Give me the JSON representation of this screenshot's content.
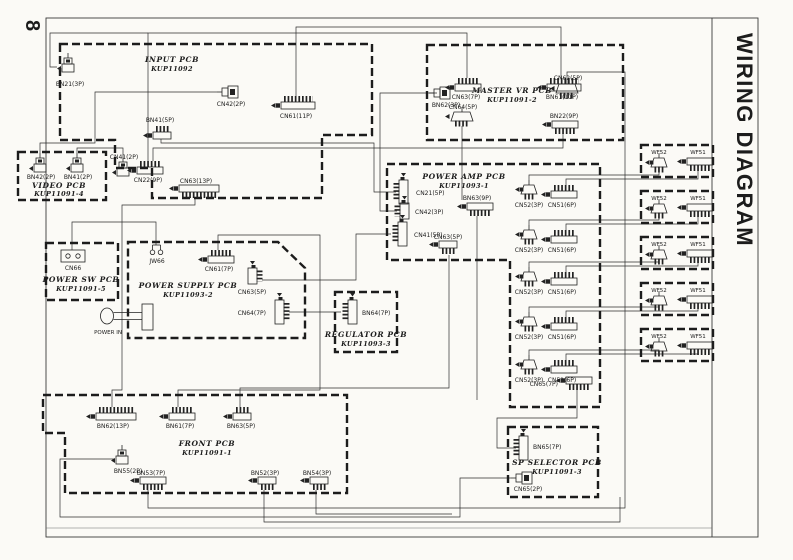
{
  "page": {
    "number": "8",
    "title": "WIRING DIAGRAM"
  },
  "pcbs": {
    "input": {
      "name": "INPUT PCB",
      "model": "KUP11092",
      "connectors": {
        "bn21": "BN21(3P)",
        "cn42": "CN42(2P)",
        "cn61": "CN61(11P)",
        "bn41": "BN41(5P)",
        "cn41": "CN41(2P)",
        "cn22": "CN22(9P)",
        "cn63": "CN63(13P)"
      }
    },
    "video": {
      "name": "VIDEO PCB",
      "model": "KUP11091-4",
      "connectors": {
        "bn42": "BN42(2P)",
        "bn41": "BN41(2P)"
      }
    },
    "master_vr": {
      "name": "MASTER VR PCB",
      "model": "KUP11091-2",
      "connectors": {
        "cn63": "CN63(7P)",
        "bn61": "BN61(11P)",
        "bn62": "BN62(3P)",
        "cn62": "CN62(5P)",
        "cn64": "CN64(5P)",
        "bn22": "BN22(9P)"
      }
    },
    "power_amp": {
      "name": "POWER AMP PCB",
      "model": "KUP11093-1",
      "connectors": {
        "cn21": "CN21(5P)",
        "cn42": "CN42(3P)",
        "cn41": "CN41(5P)",
        "bn63": "BN63(9P)",
        "cn63": "CN63(5P)",
        "cn52": "CN52(3P)",
        "cn51": "CN51(6P)",
        "cn65": "CN65(7P)"
      }
    },
    "power_sw": {
      "name": "POWER SW PCB",
      "model": "KUP11091-5",
      "connectors": {
        "cn66": "CN66"
      }
    },
    "power_supply": {
      "name": "POWER SUPPLY PCB",
      "model": "KUP11093-2",
      "power_in_label": "POWER IN",
      "connectors": {
        "jw66": "JW66",
        "cn61": "CN61(7P)",
        "cn63": "CN63(5P)",
        "cn64": "CN64(7P)"
      }
    },
    "regulator": {
      "name": "REGULATOR PCB",
      "model": "KUP11093-3",
      "connectors": {
        "bn64": "BN64(7P)"
      }
    },
    "front": {
      "name": "FRONT PCB",
      "model": "KUP11091-1",
      "connectors": {
        "bn62": "BN62(13P)",
        "bn61": "BN61(7P)",
        "bn63": "BN63(5P)",
        "bn55": "BN55(2P)",
        "bn53": "BN53(7P)",
        "bn52": "BN52(3P)",
        "bn54": "BN54(3P)"
      }
    },
    "sp_selector": {
      "name": "SP SELECTOR PCB",
      "model": "KUP11091-3",
      "connectors": {
        "bn65": "BN65(7P)",
        "cn65": "CN65(2P)"
      }
    }
  },
  "speakers": {
    "wf52": "WF52",
    "wf51": "WF51",
    "unit_count": 5
  },
  "colors": {
    "ink": "#222222",
    "paper": "#fbfaf6"
  }
}
